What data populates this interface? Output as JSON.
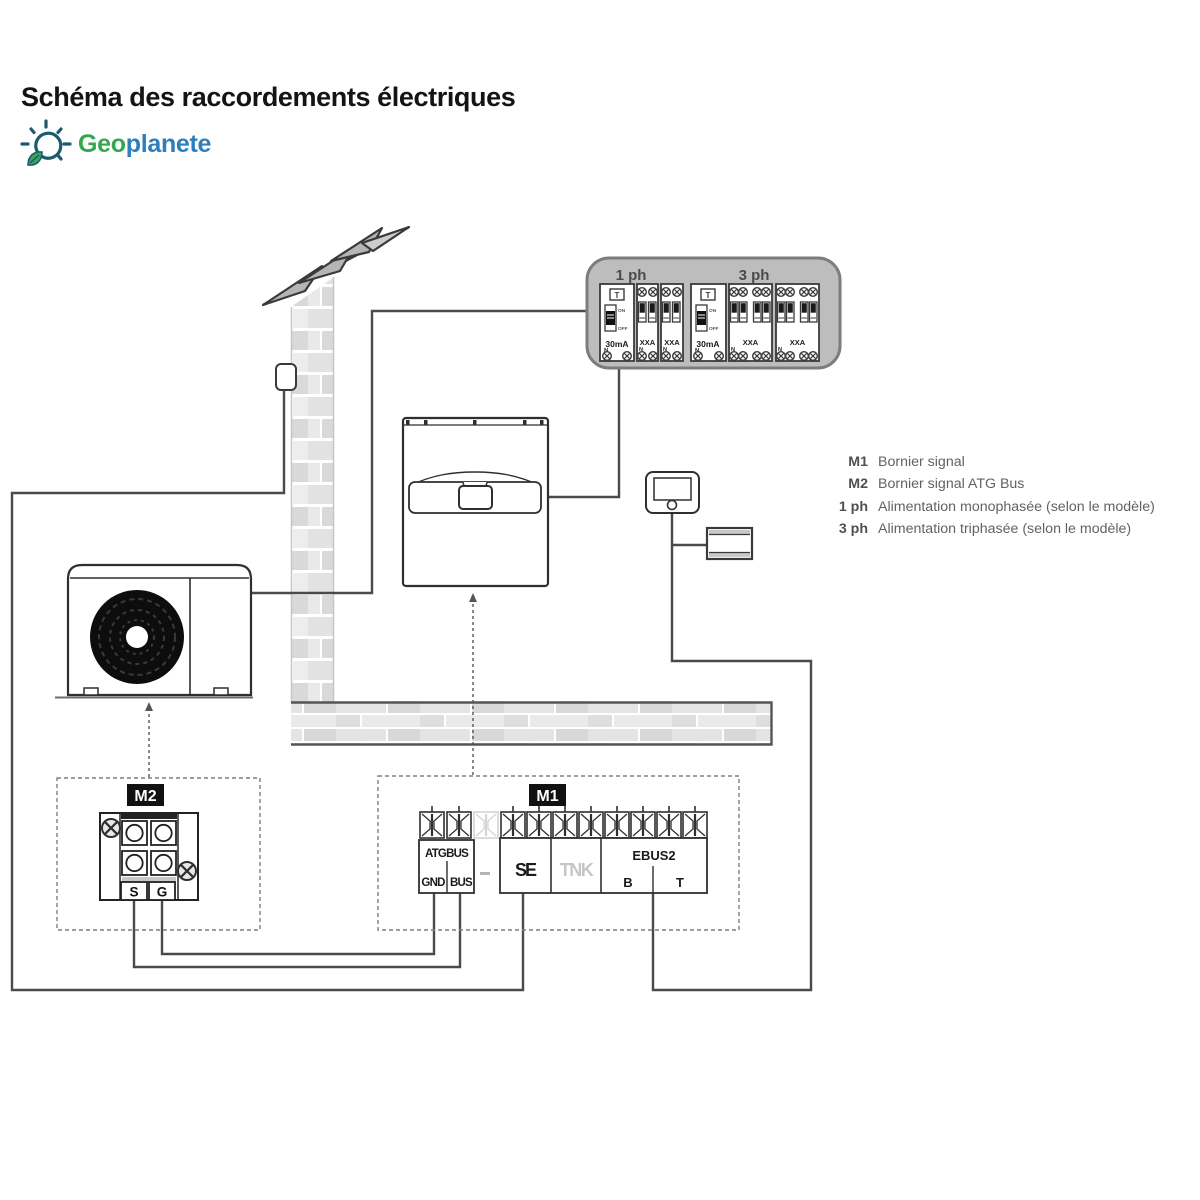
{
  "header": {
    "title": "Schéma des raccordements électriques",
    "logo": {
      "part1": "Geo",
      "part2": "planete"
    }
  },
  "legend": {
    "rows": [
      {
        "key": "M1",
        "value": "Bornier signal"
      },
      {
        "key": "M2",
        "value": "Bornier signal ATG Bus"
      },
      {
        "key": "1 ph",
        "value": "Alimentation monophasée (selon le modèle)"
      },
      {
        "key": "3 ph",
        "value": "Alimentation triphasée (selon le modèle)"
      }
    ]
  },
  "panel": {
    "section_1ph": "1 ph",
    "section_3ph": "3 ph",
    "test": "T",
    "on": "ON",
    "off": "OFF",
    "rcd_rating": "30mA",
    "breaker_rating": "XXA",
    "neutral": "N"
  },
  "terminal_m1": {
    "tag": "M1",
    "group": "ATGBUS",
    "gnd": "GND",
    "bus": "BUS",
    "se": "SE",
    "tnk": "TNK",
    "ebus2": "EBUS2",
    "b": "B",
    "t": "T"
  },
  "terminal_m2": {
    "tag": "M2",
    "s": "S",
    "g": "G"
  },
  "accent_colors": {
    "logo_green": "#33a74f",
    "logo_blue": "#2b7fbe",
    "panel_gray": "#bdbdbd",
    "line_dark": "#3a3a3a"
  }
}
